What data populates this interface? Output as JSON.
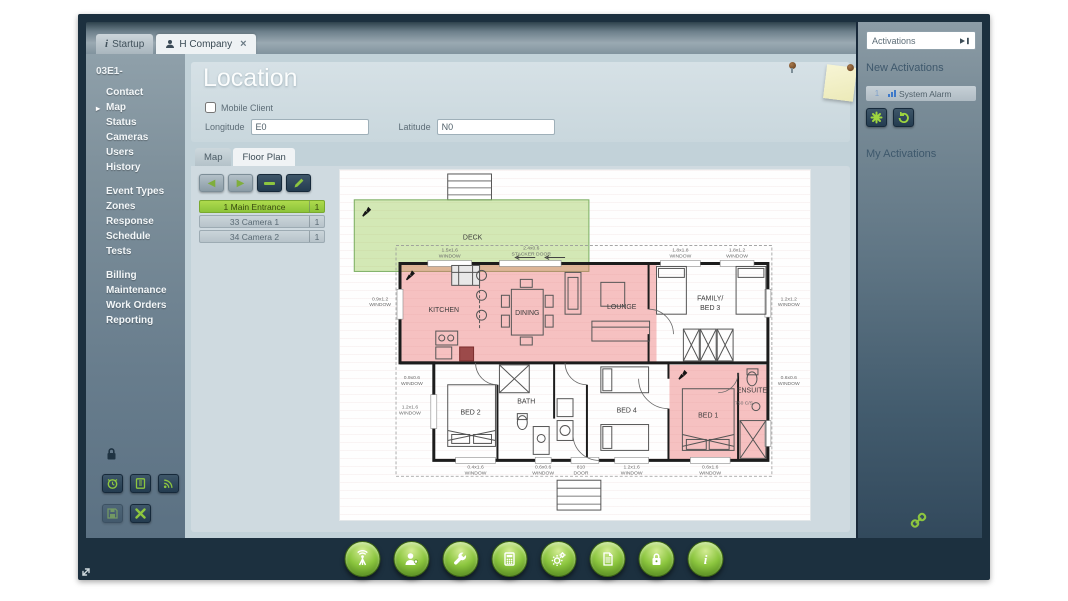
{
  "window": {
    "tabs": [
      {
        "label": "Startup",
        "icon": "info"
      },
      {
        "label": "H Company",
        "icon": "person",
        "close": "×"
      }
    ]
  },
  "sidebar": {
    "account_id": "03E1-",
    "group1": [
      "Contact",
      "Map",
      "Status",
      "Cameras",
      "Users",
      "History"
    ],
    "group2": [
      "Event Types",
      "Zones",
      "Response",
      "Schedule",
      "Tests"
    ],
    "group3": [
      "Billing",
      "Maintenance",
      "Work Orders",
      "Reporting"
    ],
    "active_item": "Map"
  },
  "location": {
    "title": "Location",
    "mobile_client_label": "Mobile Client",
    "longitude_label": "Longitude",
    "longitude_value": "E0",
    "latitude_label": "Latitude",
    "latitude_value": "N0"
  },
  "plan_tabs": {
    "map": "Map",
    "floor_plan": "Floor Plan",
    "active": "Floor Plan"
  },
  "zones": [
    {
      "label": "1 Main Entrance",
      "count": "1"
    },
    {
      "label": "33 Camera 1",
      "count": "1"
    },
    {
      "label": "34 Camera 2",
      "count": "1"
    }
  ],
  "right_panel": {
    "dropdown_label": "Activations",
    "new_activations_title": "New Activations",
    "alarm_label": "System Alarm",
    "alarm_count": "1",
    "my_activations_title": "My Activations"
  },
  "dock": {
    "buttons": [
      "wireless",
      "users",
      "tools",
      "calculator",
      "settings",
      "reports",
      "security",
      "info"
    ]
  },
  "floorplan": {
    "rooms": {
      "deck": "DECK",
      "kitchen": "KITCHEN",
      "dining": "DINING",
      "lounge": "LOUNGE",
      "family1": "FAMILY/",
      "family2": "BED 3",
      "bed2": "BED 2",
      "bath": "BATH",
      "bed4": "BED 4",
      "bed1": "BED 1",
      "ensuite": "ENSUITE"
    },
    "dims": {
      "t1a": "1.5x1.6",
      "t1b": "WINDOW",
      "t2a": "2.4x0.6",
      "t2b": "STACKER DOOR",
      "t3a": "1.8x1.8",
      "t3b": "WINDOW",
      "t4a": "1.8x1.2",
      "t4b": "WINDOW",
      "l1a": "0.9x1.2",
      "l1b": "WINDOW",
      "l2a": "0.9x0.6",
      "l2b": "WINDOW",
      "l3a": "1.2x1.6",
      "l3b": "WINDOW",
      "r1a": "1.2x1.2",
      "r1b": "WINDOW",
      "r2a": "0.6x0.6",
      "r2b": "WINDOW",
      "b1a": "0.4x1.6",
      "b1b": "WINDOW",
      "b2a": "0.6x0.6",
      "b2b": "WINDOW",
      "b3a": "810",
      "b3b": "DOOR",
      "b4a": "1.2x1.6",
      "b4b": "WINDOW",
      "b5a": "0.6x1.6",
      "b5b": "WINDOW",
      "cs": "750 C/S"
    }
  },
  "colors": {
    "accent_green": "#8dc63f",
    "zone_red": "#eb6e6e",
    "zone_green": "#8dc63f",
    "frame": "#1c303f"
  }
}
